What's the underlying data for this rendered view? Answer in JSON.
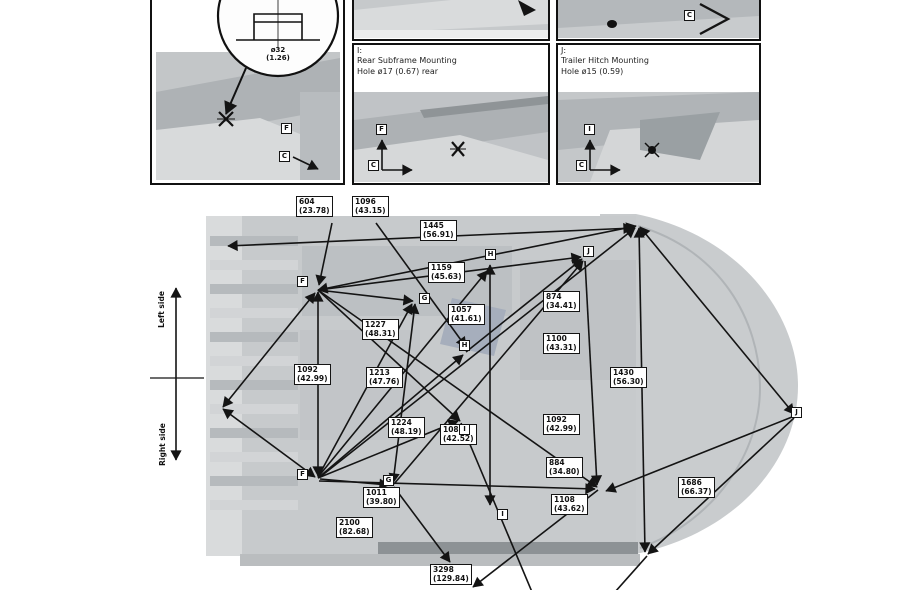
{
  "colors": {
    "line": "#141414",
    "box_border": "#141414",
    "photo_gray": "#c5c8ca",
    "car_gray": "#c9ccce"
  },
  "panels": {
    "a": {
      "callout_mm": "ø32",
      "callout_in": "(1.26)",
      "point": "F",
      "axis": "C"
    },
    "b": {
      "key": "I:",
      "title": "Rear Subframe Mounting",
      "subtitle": "Hole ø17 (0.67) rear",
      "point": "F",
      "axis": "C"
    },
    "c": {
      "key": "J:",
      "title": "Trailer Hitch Mounting",
      "subtitle": "Hole ø15 (0.59)",
      "point": "I",
      "axis": "C",
      "top_axis": "C"
    }
  },
  "orientation": {
    "top": "Left side",
    "bottom": "Right side"
  },
  "measurements": [
    {
      "mm": "604",
      "in": "(23.78)"
    },
    {
      "mm": "1096",
      "in": "(43.15)"
    },
    {
      "mm": "1445",
      "in": "(56.91)"
    },
    {
      "mm": "1159",
      "in": "(45.63)"
    },
    {
      "mm": "1057",
      "in": "(41.61)"
    },
    {
      "mm": "874",
      "in": "(34.41)"
    },
    {
      "mm": "1100",
      "in": "(43.31)"
    },
    {
      "mm": "1092",
      "in": "(42.99)"
    },
    {
      "mm": "1227",
      "in": "(48.31)"
    },
    {
      "mm": "1213",
      "in": "(47.76)"
    },
    {
      "mm": "1224",
      "in": "(48.19)"
    },
    {
      "mm": "1080",
      "in": "(42.52)"
    },
    {
      "mm": "1092",
      "in": "(42.99)"
    },
    {
      "mm": "884",
      "in": "(34.80)"
    },
    {
      "mm": "1108",
      "in": "(43.62)"
    },
    {
      "mm": "1430",
      "in": "(56.30)"
    },
    {
      "mm": "1686",
      "in": "(66.37)"
    },
    {
      "mm": "1011",
      "in": "(39.80)"
    },
    {
      "mm": "2100",
      "in": "(82.68)"
    },
    {
      "mm": "3298",
      "in": "(129.84)"
    }
  ],
  "points": [
    {
      "label": "F"
    },
    {
      "label": "G"
    },
    {
      "label": "H"
    },
    {
      "label": "H"
    },
    {
      "label": "J"
    },
    {
      "label": "I"
    },
    {
      "label": "F"
    },
    {
      "label": "G"
    },
    {
      "label": "I"
    },
    {
      "label": "J"
    }
  ]
}
